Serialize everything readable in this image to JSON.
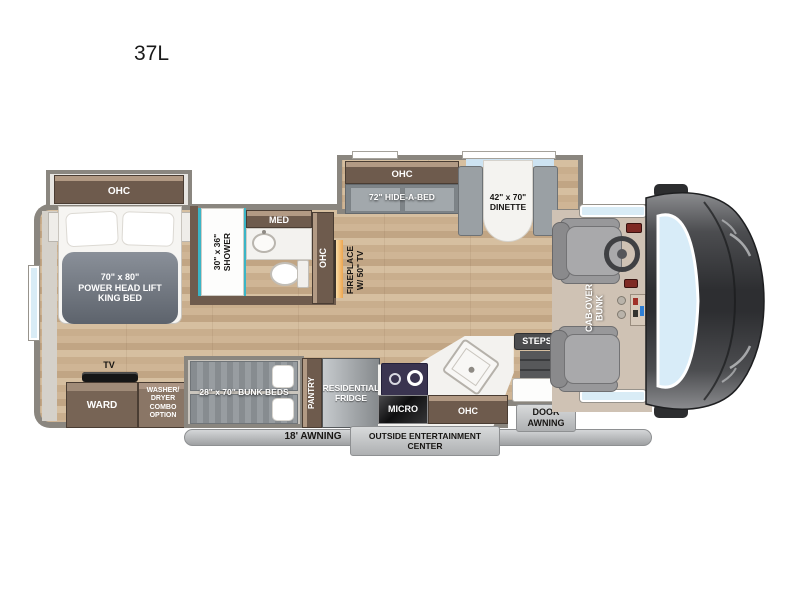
{
  "model": "37L",
  "colors": {
    "wall_gray": "#8a867f",
    "cabinet_brown": "#6e5b4d",
    "accent_teal": "#3ab5c6",
    "windshield_blue": "#d8ecf8",
    "floor_tan": "#cab08f"
  },
  "bedroom": {
    "ohc": "OHC",
    "bed": "70\" x 80\"\nPOWER  HEAD LIFT\nKING BED",
    "tv": "TV",
    "ward": "WARD",
    "washer_dryer": "WASHER/\nDRYER\nCOMBO\nOPTION"
  },
  "bathroom": {
    "shower": "30\" x 36\"\nSHOWER",
    "med": "MED",
    "ohc": "OHC"
  },
  "living": {
    "fireplace": "FIREPLACE\nW/ 50\" TV",
    "ohc": "OHC",
    "hide_a_bed": "72\" HIDE-A-BED",
    "dinette": "42\" x 70\"\nDINETTE"
  },
  "kitchen": {
    "pantry": "PANTRY",
    "fridge": "RESIDENTIAL\nFRIDGE",
    "micro": "MICRO",
    "ohc": "OHC"
  },
  "bunks": {
    "label": "28\" x 70\" BUNK BEDS"
  },
  "cab": {
    "bunk": "CAB-OVER\nBUNK",
    "steps": "STEPS"
  },
  "exterior": {
    "awning": "18' AWNING",
    "entertainment": "OUTSIDE ENTERTAINMENT\nCENTER",
    "door_awning": "DOOR\nAWNING"
  }
}
